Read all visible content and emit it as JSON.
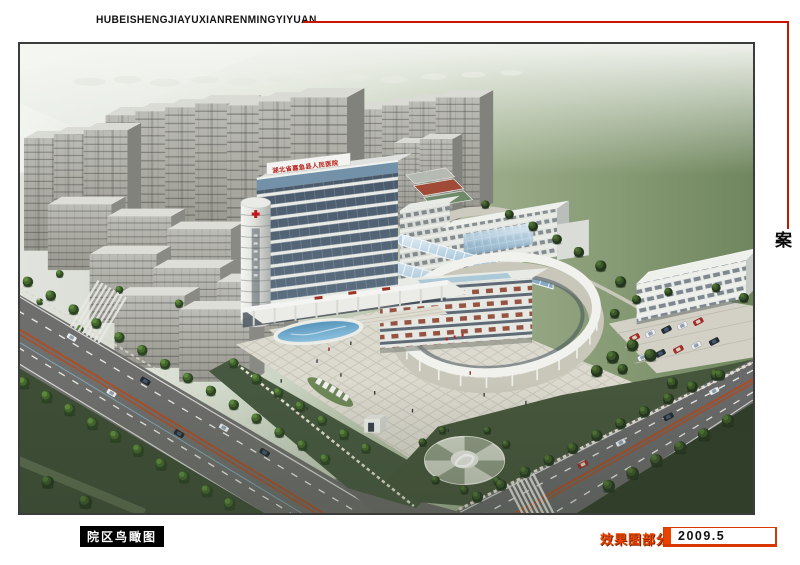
{
  "header": {
    "pinyin_title": "HUBEISHENGJIAYUXIANRENMINGYIYUAN"
  },
  "side_title": {
    "text": "湖北省嘉鱼县人民医院规划设计方案"
  },
  "caption_tag": {
    "text": "院区鸟瞰图"
  },
  "footer": {
    "section_label": "效果图部分",
    "date": "2009.5"
  },
  "rendering": {
    "rooftop_sign_text": "湖北省嘉鱼县人民医院"
  },
  "colors": {
    "accent_line": "#c81400",
    "footer_red": "#e64400",
    "caption_bg": "#000000"
  }
}
